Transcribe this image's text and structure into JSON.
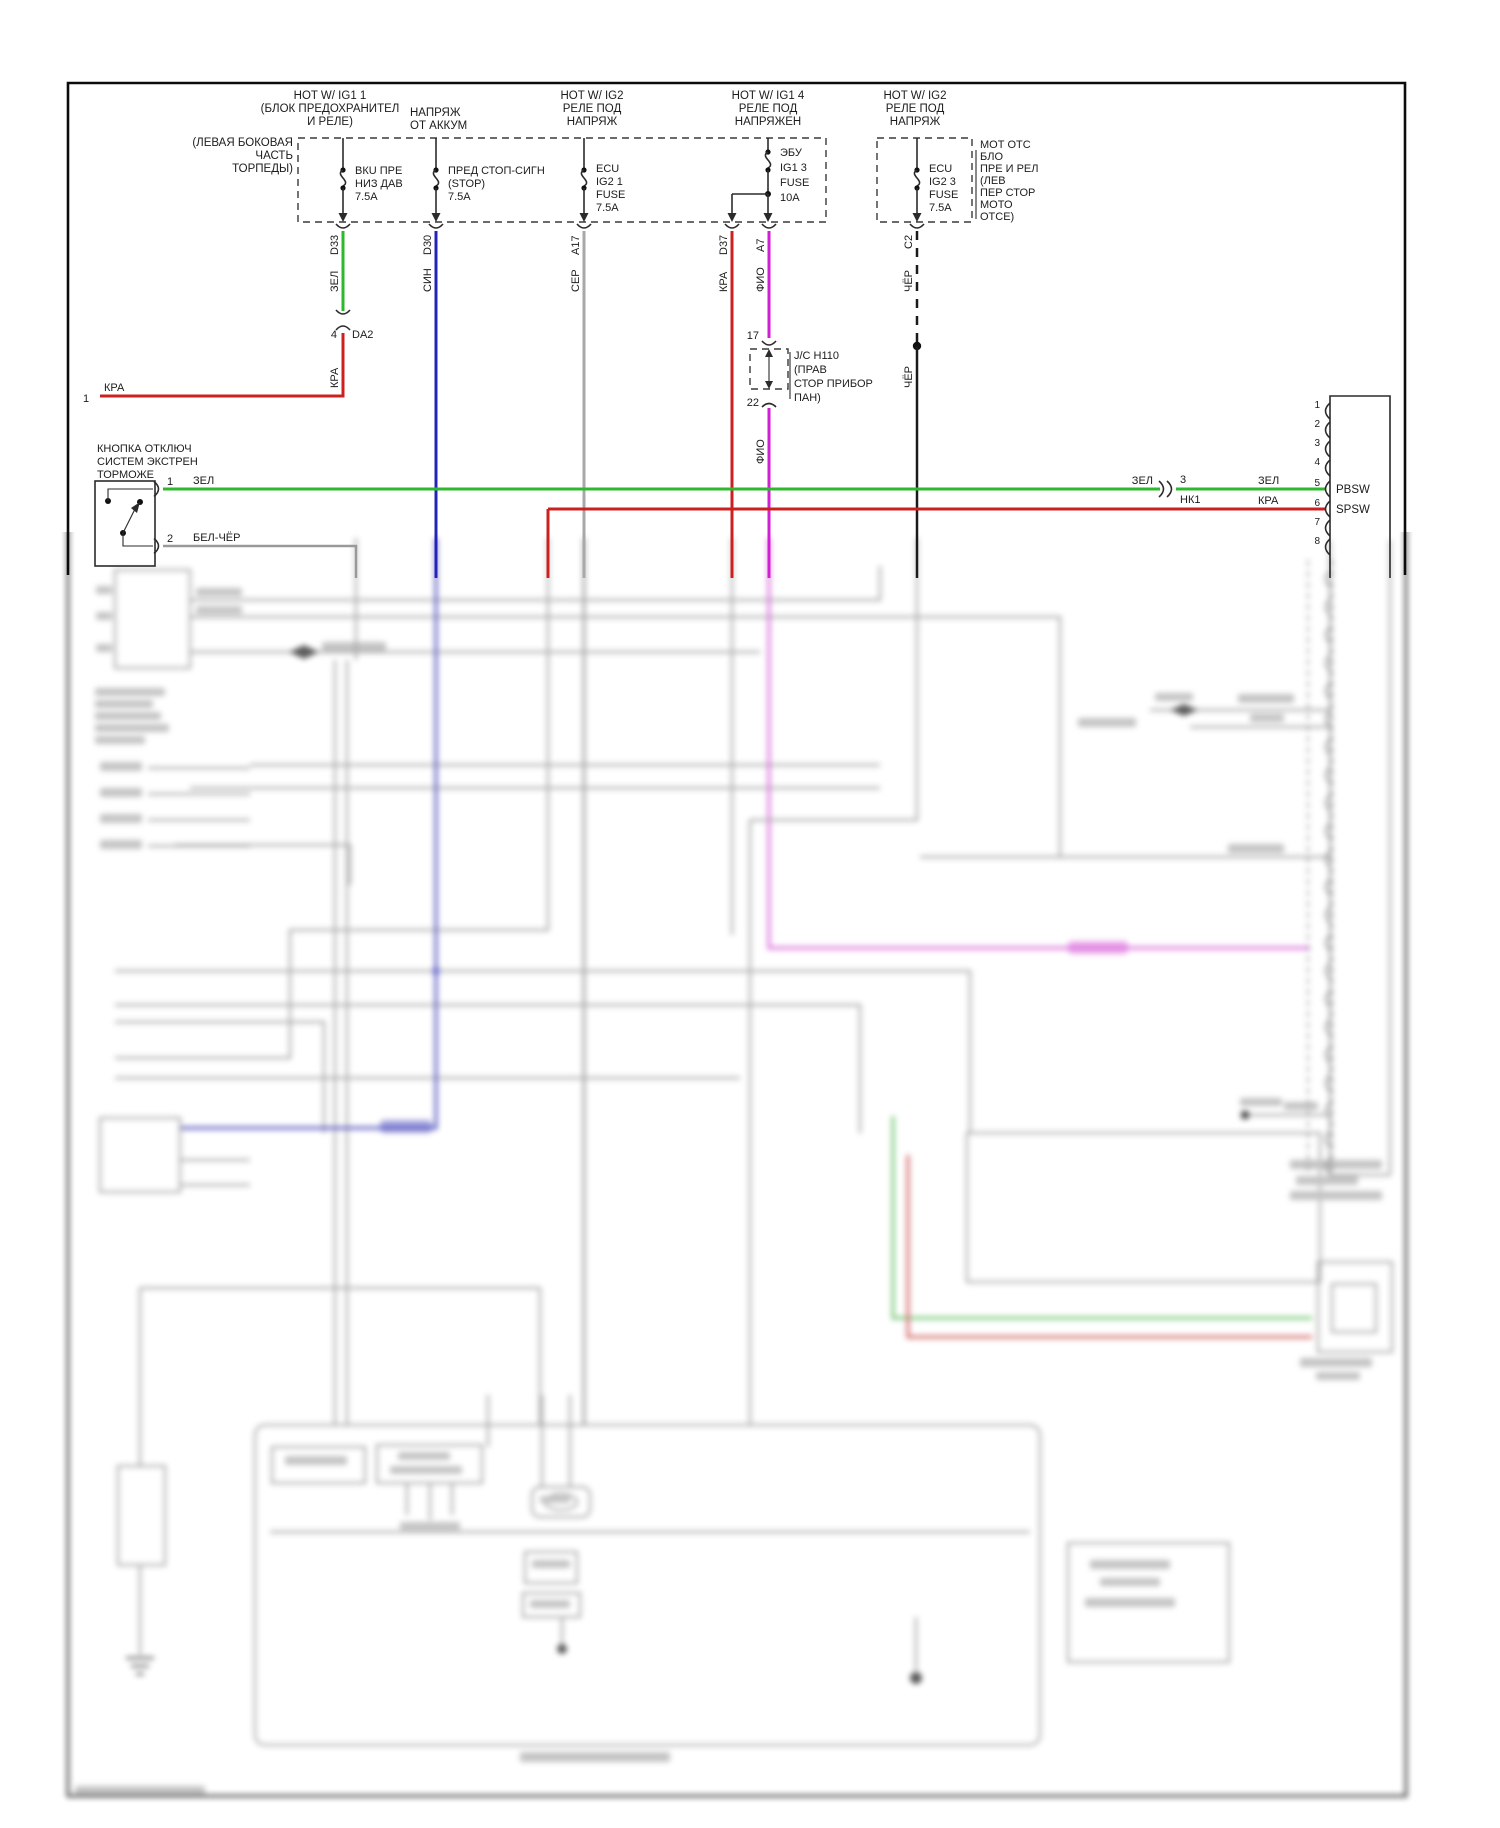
{
  "colors": {
    "green": "#2db82d",
    "blue": "#2323b8",
    "gray_wire": "#a8a8a8",
    "red": "#cc2020",
    "magenta": "#d31fd3",
    "black_wire": "#1a1a1a",
    "white_black": "#999999"
  },
  "blur_colors": {
    "red": "#d04545",
    "green": "#55bb55",
    "blue": "#3333bb",
    "periwinkle": "#8585e0",
    "magenta": "#d84fd8",
    "pink": "#e070e0",
    "salmon": "#e08080",
    "sage": "#9aa89a",
    "tan": "#b39544",
    "gray": "#909090",
    "dark": "#666666"
  },
  "headers": {
    "h1": [
      "HOT W/ IG1 1",
      "(БЛОК ПРЕДОХРАНИТЕЛ",
      "И РЕЛЕ)"
    ],
    "h2": [
      "НАПРЯЖ",
      "ОТ АККУМ"
    ],
    "left_note": [
      "(ЛЕВАЯ БОКОВАЯ",
      "ЧАСТЬ",
      "ТОРПЕДЫ)"
    ],
    "h3": [
      "HOT W/ IG2",
      "РЕЛЕ ПОД",
      "НАПРЯЖ"
    ],
    "h4": [
      "HOT W/ IG1 4",
      "РЕЛЕ ПОД",
      "НАПРЯЖЕН"
    ],
    "h5": [
      "HOT W/ IG2",
      "РЕЛЕ ПОД",
      "НАПРЯЖ"
    ],
    "right_note": [
      "МОТ ОТС",
      "БЛО",
      "ПРЕ И РЕЛ",
      "(ЛЕВ",
      "ПЕР СТОР",
      "МОТО",
      "ОТСЕ)"
    ]
  },
  "fuses": {
    "f1": [
      "ВКU ПРЕ",
      "НИЗ ДАВ",
      "7.5A"
    ],
    "f2": [
      "ПРЕД СТОП-СИГН",
      "(STOP)",
      "7.5A"
    ],
    "f3": [
      "ECU",
      "IG2 1",
      "FUSE",
      "7.5A"
    ],
    "f4": [
      "ЭБУ",
      "IG1 3",
      "FUSE",
      "10A"
    ],
    "f5": [
      "ECU",
      "IG2 3",
      "FUSE",
      "7.5A"
    ]
  },
  "wire_labels": {
    "c1": "D33",
    "c2": "D30",
    "c3": "A17",
    "c4": "D37",
    "c5": "A7",
    "c6": "C2",
    "w1": "ЗЕЛ",
    "w2": "СИН",
    "w3": "СЕР",
    "w4": "КРА",
    "w5": "ФИО",
    "w6": "ЧЁР",
    "w6b": "ЧЁР",
    "w5b": "ФИО"
  },
  "da2": {
    "pin": "4",
    "name": "DA2",
    "wire": "КРА",
    "left_pin": "1",
    "left_wire": "КРА"
  },
  "jc": {
    "top": "17",
    "bottom": "22",
    "name": "J/C H110",
    "loc1": "(ПРАВ",
    "loc2": "СТОР ПРИБОР",
    "loc3": "ПАН)"
  },
  "switch": {
    "l1": "КНОПКА ОТКЛЮЧ",
    "l2": "СИСТЕМ ЭКСТРЕН",
    "l3": "ТОРМОЖЕ",
    "pin1": "1",
    "pin2": "2",
    "wire1": "ЗЕЛ",
    "wire2": "БЕЛ-ЧЁР"
  },
  "inline": {
    "left": "ЗЕЛ",
    "pin": "3",
    "name": "НК1",
    "right": "ЗЕЛ",
    "red": "КРА"
  },
  "connector": {
    "pins": [
      "1",
      "2",
      "3",
      "4",
      "5",
      "6",
      "7",
      "8"
    ],
    "pin5": "PBSW",
    "pin6": "SPSW"
  }
}
